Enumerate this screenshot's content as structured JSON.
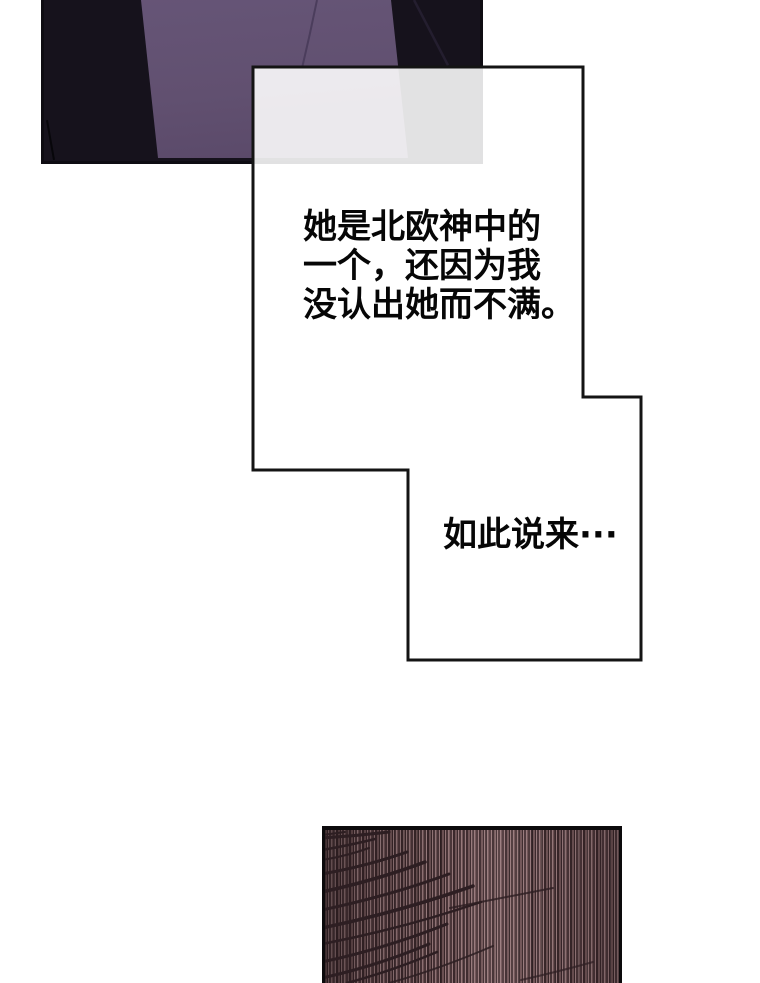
{
  "colors": {
    "panel-black": "#16121c",
    "panel-purple": "#615070",
    "panel-purple-dark": "#594868",
    "purple-fold": "#4b3d5c",
    "line-black": "#0e0c12",
    "bubble-border": "#141414",
    "text": "#060606",
    "stripe-light": "#97797b",
    "stripe-mid": "#6e5355",
    "stripe-dark": "#4a3538",
    "stripe-deep": "#382629",
    "grass": "#2d1e22"
  },
  "bubble": {
    "lines": [
      "她是北欧神中的",
      "一个，还因为我",
      "没认出她而不满。"
    ],
    "aside": "如此说来···"
  }
}
